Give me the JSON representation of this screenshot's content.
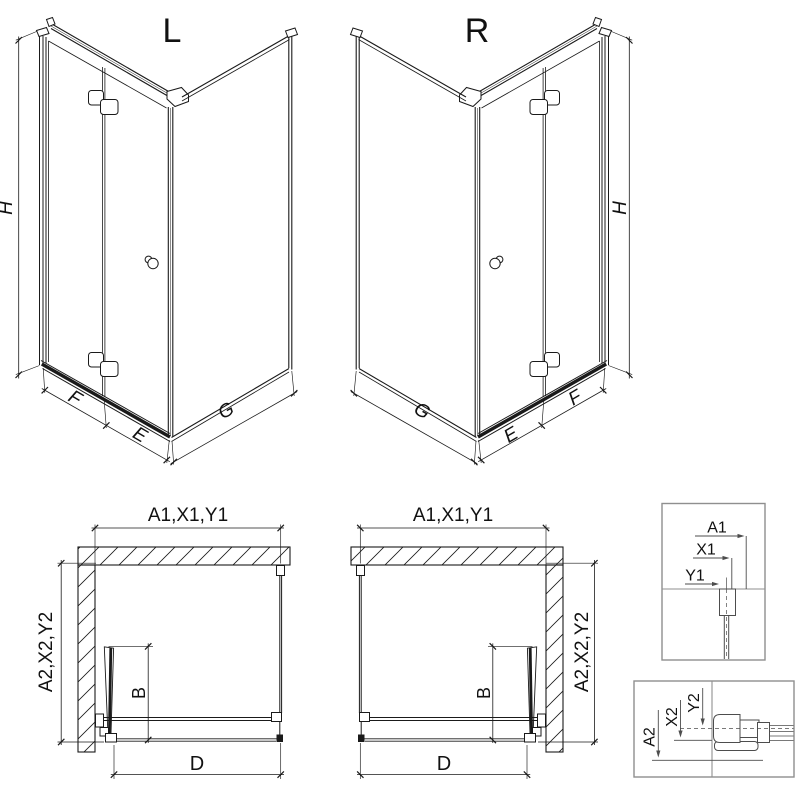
{
  "diagrams": {
    "iso_left": {
      "title": "L",
      "dim_height": "H",
      "dim_panel_f": "F",
      "dim_panel_e": "E",
      "dim_side_g": "G"
    },
    "iso_right": {
      "title": "R",
      "dim_height": "H",
      "dim_panel_f": "F",
      "dim_panel_e": "E",
      "dim_side_g": "G"
    },
    "plan_left": {
      "dim_top": "A1,X1,Y1",
      "dim_side": "A2,X2,Y2",
      "dim_fold": "B",
      "dim_width": "D"
    },
    "plan_right": {
      "dim_top": "A1,X1,Y1",
      "dim_side": "A2,X2,Y2",
      "dim_fold": "B",
      "dim_width": "D"
    },
    "detail_top": {
      "a": "A1",
      "x": "X1",
      "y": "Y1"
    },
    "detail_bottom": {
      "a": "A2",
      "x": "X2",
      "y": "Y2"
    }
  },
  "colors": {
    "line": "#1a1a1a",
    "text": "#111111",
    "detail": "#4d4d4d",
    "boxborder": "#8f8f8f",
    "background": "#ffffff"
  }
}
